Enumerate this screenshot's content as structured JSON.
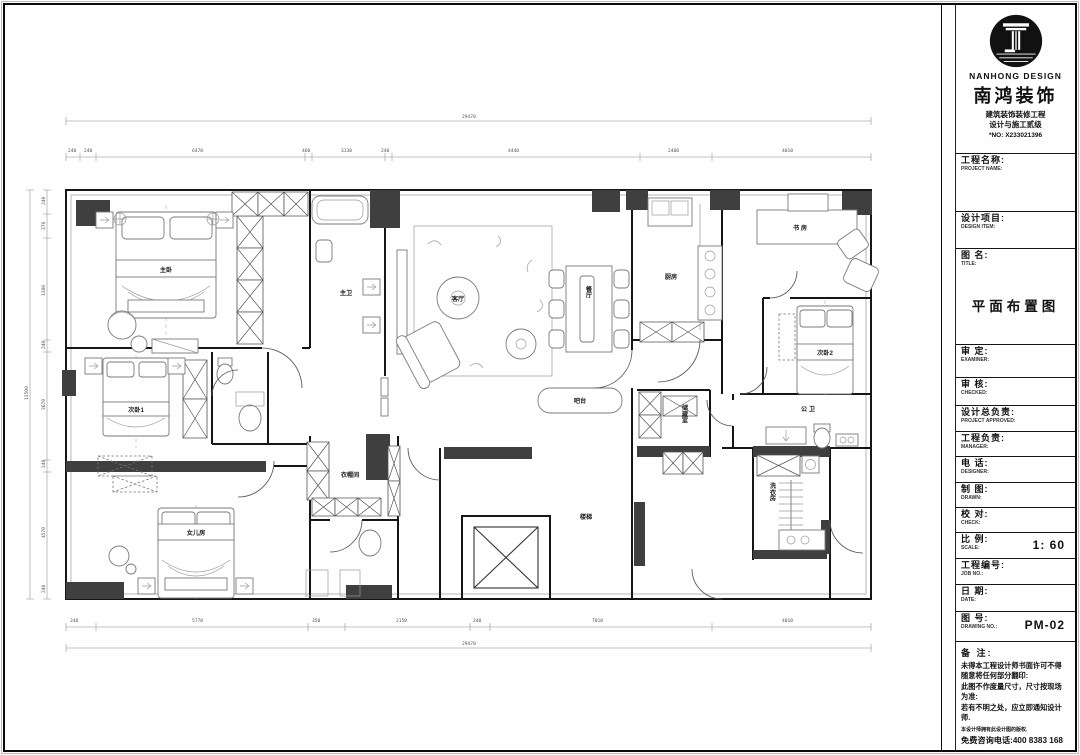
{
  "titleblock": {
    "brand": {
      "en": "NANHONG DESIGN",
      "cn": "南鸿装饰",
      "line1": "建筑装饰装修工程",
      "line2": "设计与施工贰级",
      "cert": "*NO: X233021396"
    },
    "rows": [
      {
        "cn": "工程名称:",
        "en": "PROJECT NAME:",
        "value": ""
      },
      {
        "cn": "设计项目:",
        "en": "DESIGN ITEM:",
        "value": ""
      },
      {
        "cn": "图 名:",
        "en": "TITLE:",
        "value": "平面布置图"
      },
      {
        "cn": "审 定:",
        "en": "EXAMINER:",
        "value": ""
      },
      {
        "cn": "审 核:",
        "en": "CHECKED:",
        "value": ""
      },
      {
        "cn": "设计总负责:",
        "en": "PROJECT APPROVED:",
        "value": ""
      },
      {
        "cn": "工程负责:",
        "en": "MANAGER:",
        "value": ""
      },
      {
        "cn": "电 话:",
        "en": "DESIGNER:",
        "value": ""
      },
      {
        "cn": "制 图:",
        "en": "DRAWN:",
        "value": ""
      },
      {
        "cn": "校 对:",
        "en": "CHECK:",
        "value": ""
      },
      {
        "cn": "比 例:",
        "en": "SCALE:",
        "value": "1: 60"
      },
      {
        "cn": "工程编号:",
        "en": "JOB NO.:",
        "value": ""
      },
      {
        "cn": "日 期:",
        "en": "DATE:",
        "value": ""
      },
      {
        "cn": "图 号:",
        "en": "DRAWING NO.:",
        "value": "PM-02"
      }
    ],
    "notes": {
      "heading": "备 注:",
      "lines": [
        "未得本工程设计师书面许可不得",
        "随意将任何部分翻印:",
        "此图不作度量尺寸，尺寸按现场",
        "为准:",
        "若有不明之处，应立即通知设计",
        "师.",
        "本设计师拥有此设计图的版权."
      ],
      "hotline": "免费咨询电话:400 8383 168"
    }
  },
  "plan": {
    "rooms": [
      {
        "id": "master-bedroom",
        "label": "主卧"
      },
      {
        "id": "master-bath",
        "label": "主卫"
      },
      {
        "id": "living-room",
        "label": "客厅"
      },
      {
        "id": "dining-room",
        "label": "餐厅"
      },
      {
        "id": "kitchen",
        "label": "厨房"
      },
      {
        "id": "study",
        "label": "书 房"
      },
      {
        "id": "bedroom-2",
        "label": "次卧2"
      },
      {
        "id": "public-bath",
        "label": "公 卫"
      },
      {
        "id": "storage",
        "label": "储藏室"
      },
      {
        "id": "laundry",
        "label": "洗衣房"
      },
      {
        "id": "bar",
        "label": "吧台"
      },
      {
        "id": "stairs",
        "label": "楼梯"
      },
      {
        "id": "bedroom-1",
        "label": "次卧1"
      },
      {
        "id": "daughter-room",
        "label": "女儿房"
      },
      {
        "id": "cloakroom",
        "label": "衣帽间"
      }
    ],
    "dims": {
      "top_total": "29470",
      "bottom_total": "29470",
      "left_total": "13500",
      "top": [
        "240",
        "240",
        "6470",
        "460",
        "3130",
        "240",
        "4440",
        "2400",
        "4010"
      ],
      "bottom": [
        "240",
        "5770",
        "350",
        "2150",
        "240",
        "7010",
        "4010"
      ],
      "left": [
        "240",
        "370",
        "1380",
        "240",
        "3670",
        "240",
        "4570",
        "240"
      ]
    }
  }
}
